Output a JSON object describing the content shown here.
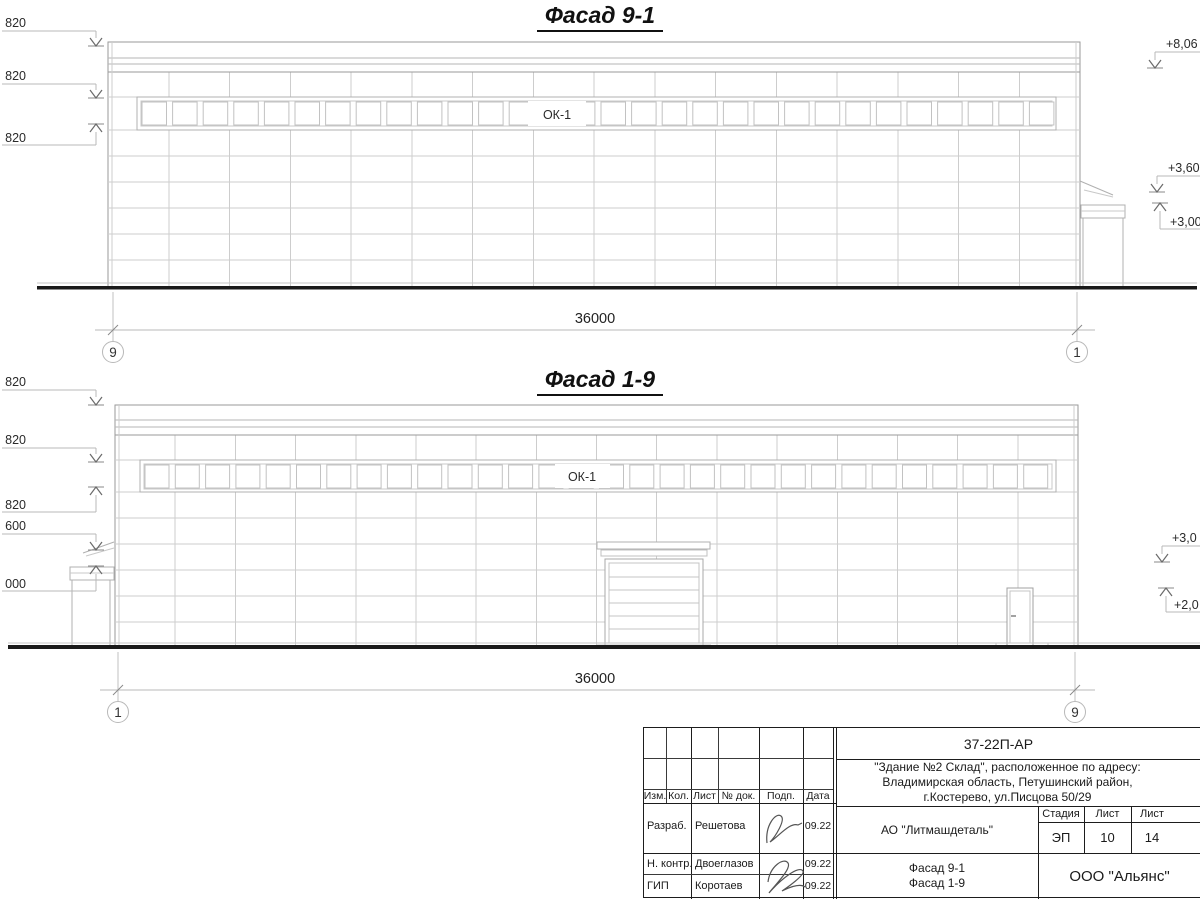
{
  "facades": {
    "top": {
      "title": "Фасад 9-1",
      "window_label": "ОК-1",
      "dim_text": "36000",
      "axis_left": "9",
      "axis_right": "1",
      "marks_left": [
        "820",
        "820",
        "820"
      ],
      "marks_right": [
        "+8,06",
        "+3,60",
        "+3,00"
      ]
    },
    "bottom": {
      "title": "Фасад 1-9",
      "window_label": "ОК-1",
      "dim_text": "36000",
      "axis_left": "1",
      "axis_right": "9",
      "marks_left": [
        "820",
        "820",
        "820",
        "600",
        "000"
      ],
      "marks_right": [
        "+3,0",
        "+2,0"
      ]
    }
  },
  "titleblock": {
    "doc_number": "37-22П-АР",
    "object_address_lines": [
      "\"Здание №2 Склад\", расположенное по адресу:",
      "Владимирская область, Петушинский район,",
      "г.Костерево, ул.Писцова 50/29"
    ],
    "columns": [
      "Изм.",
      "Кол.",
      "Лист",
      "№ док.",
      "Подп.",
      "Дата"
    ],
    "signers": [
      {
        "role": "Разраб.",
        "name": "Решетова",
        "date": "09.22"
      },
      {
        "role": "Н. контр.",
        "name": "Двоеглазов",
        "date": "09.22"
      },
      {
        "role": "ГИП",
        "name": "Коротаев",
        "date": "09.22"
      }
    ],
    "client": "АО \"Литмашдеталь\"",
    "stage_label": "Стадия",
    "stage": "ЭП",
    "sheet_label": "Лист",
    "sheet": "10",
    "sheets_label": "Лист",
    "sheets": "14",
    "sheet_titles": [
      "Фасад 9-1",
      "Фасад 1-9"
    ],
    "organization": "ООО \"Альянс\""
  }
}
